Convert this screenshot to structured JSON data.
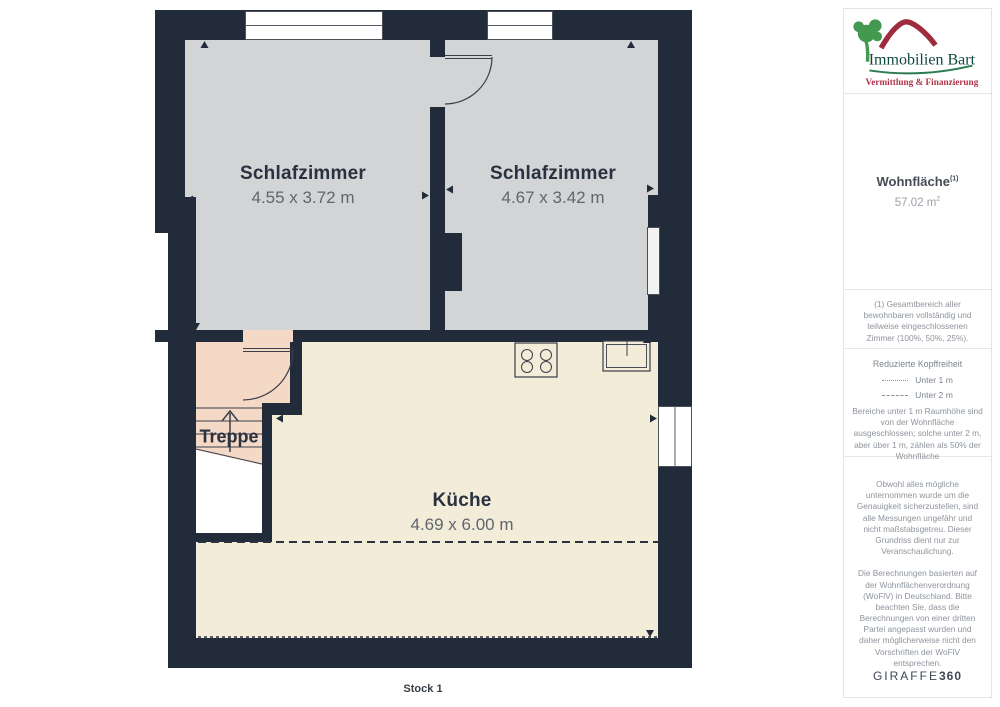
{
  "plan": {
    "rooms": [
      {
        "name": "Schlafzimmer",
        "dims": "4.55 x 3.72 m"
      },
      {
        "name": "Schlafzimmer",
        "dims": "4.67 x 3.42 m"
      },
      {
        "name": "Küche",
        "dims": "4.69 x 6.00 m"
      },
      {
        "name": "Treppe"
      }
    ],
    "floor_label": "Stock 1",
    "colors": {
      "wall": "#222b39",
      "bedroom_floor": "#d3d4d5",
      "kitchen_floor": "#f2ecd8",
      "stair_floor": "#f4d9c7"
    }
  },
  "sidebar": {
    "logo": {
      "title": "Immobilien Bart",
      "tagline": "Vermittlung & Finanzierung",
      "colors": {
        "roof": "#9e2b3e",
        "tree": "#44984f",
        "title": "#10483c",
        "tagline": "#b23349"
      }
    },
    "area": {
      "label": "Wohnfläche",
      "label_sup": "(1)",
      "value_text": "57.02 m",
      "value_sup": "2"
    },
    "footnote1": "(1) Gesamtbereich aller bewohnbaren vollständig und teilweise eingeschlossenen Zimmer (100%, 50%, 25%).",
    "headroom": {
      "title": "Reduzierte Kopffreiheit",
      "legend": [
        {
          "style": "dotted",
          "label": "Unter 1 m"
        },
        {
          "style": "dashed",
          "label": "Unter 2 m"
        }
      ],
      "body": "Bereiche unter 1 m Raumhöhe sind von der Wohnfläche ausgeschlossen; solche unter 2 m, aber über 1 m, zählen als 50% der Wohnfläche"
    },
    "disclaimer1": "Obwohl alles mögliche unternommen wurde um die Genauigkeit sicherzustellen, sind alle Messungen ungefähr und nicht maßstabsgetreu. Dieser Grundriss dient nur zur Veranschaulichung.",
    "disclaimer2": "Die Berechnungen basierten auf der Wohnflächenverordnung (WoFlV) in Deutschland. Bitte beachten Sie, dass die Berechnungen von einer dritten Partei angepasst wurden und daher möglicherweise nicht den Vorschriften der WoFlV entsprechen.",
    "brand": {
      "name": "GIRAFFE",
      "number": "360"
    }
  }
}
